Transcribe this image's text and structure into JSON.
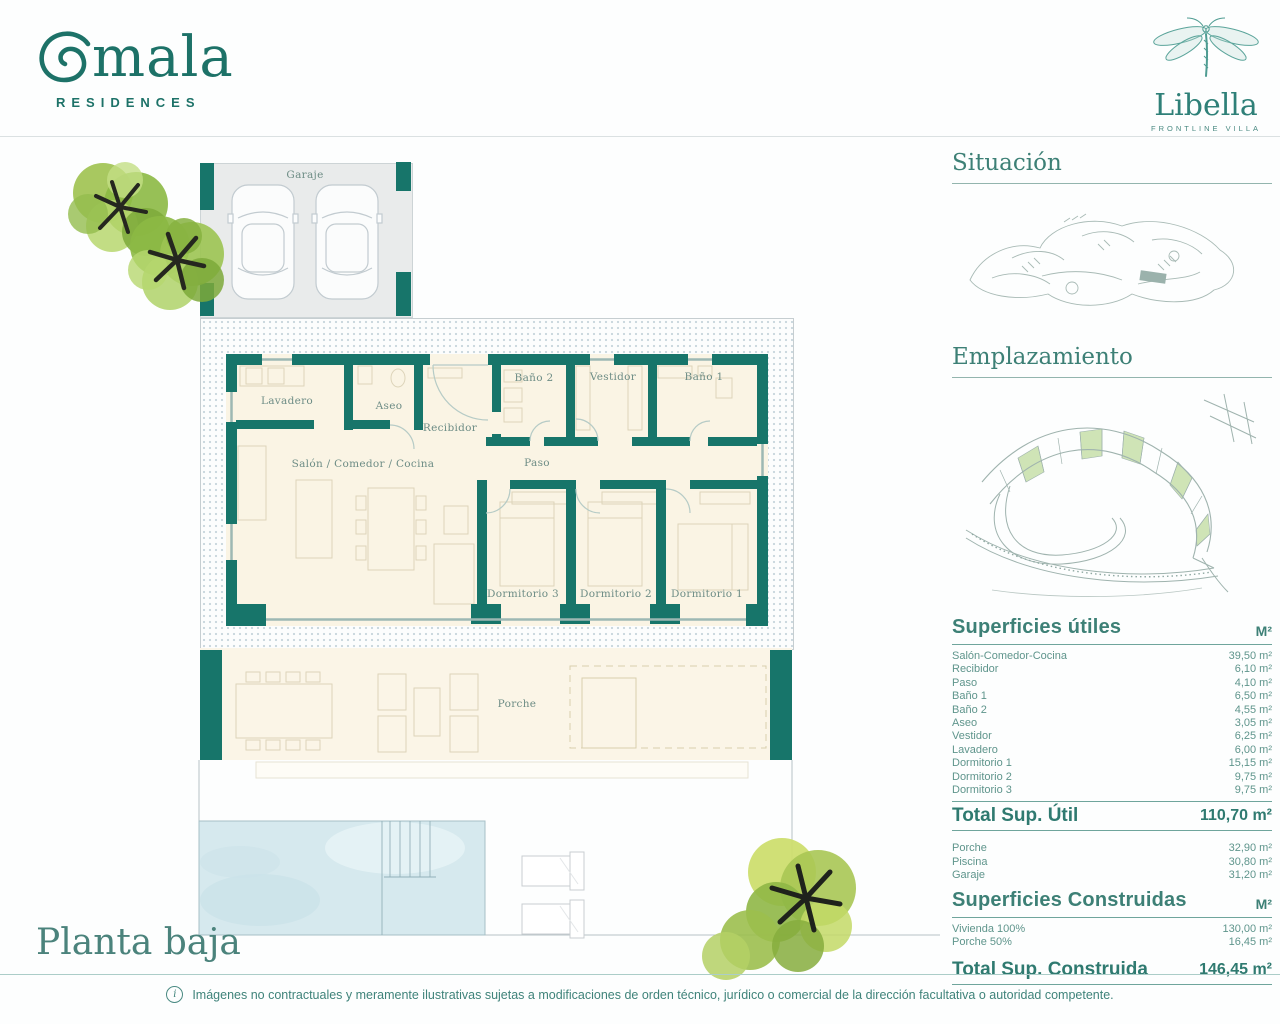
{
  "brand": {
    "name": "Omala",
    "name_rest": "mala",
    "residences": "RESIDENCES"
  },
  "villa": {
    "name": "Libella",
    "subtitle": "FRONTLINE VILLA"
  },
  "plan": {
    "title": "Planta baja",
    "rooms": {
      "garaje": "Garaje",
      "lavadero": "Lavadero",
      "aseo": "Aseo",
      "recibidor": "Recibidor",
      "bano_2": "Baño 2",
      "vestidor": "Vestidor",
      "bano_1": "Baño 1",
      "paso": "Paso",
      "salon": "Salón / Comedor / Cocina",
      "dormitorio_3": "Dormitorio 3",
      "dormitorio_2": "Dormitorio 2",
      "dormitorio_1": "Dormitorio 1",
      "porche": "Porche"
    }
  },
  "sections": {
    "situacion": "Situación",
    "emplazamiento": "Emplazamiento"
  },
  "superficies_utiles": {
    "title": "Superficies útiles",
    "unit": "M²",
    "rows": [
      {
        "label": "Salón-Comedor-Cocina",
        "value": "39,50 m²"
      },
      {
        "label": "Recibidor",
        "value": "6,10 m²"
      },
      {
        "label": "Paso",
        "value": "4,10 m²"
      },
      {
        "label": "Baño 1",
        "value": "6,50 m²"
      },
      {
        "label": "Baño 2",
        "value": "4,55 m²"
      },
      {
        "label": "Aseo",
        "value": "3,05 m²"
      },
      {
        "label": "Vestidor",
        "value": "6,25 m²"
      },
      {
        "label": "Lavadero",
        "value": "6,00 m²"
      },
      {
        "label": "Dormitorio 1",
        "value": "15,15 m²"
      },
      {
        "label": "Dormitorio 2",
        "value": "9,75 m²"
      },
      {
        "label": "Dormitorio 3",
        "value": "9,75 m²"
      }
    ],
    "total_label": "Total Sup. Útil",
    "total_value": "110,70 m²"
  },
  "superficies_anexas": {
    "rows": [
      {
        "label": "Porche",
        "value": "32,90 m²"
      },
      {
        "label": "Piscina",
        "value": "30,80 m²"
      },
      {
        "label": "Garaje",
        "value": "31,20 m²"
      }
    ]
  },
  "superficies_construidas": {
    "title": "Superficies Construidas",
    "unit": "M²",
    "rows": [
      {
        "label": "Vivienda 100%",
        "value": "130,00 m²"
      },
      {
        "label": "Porche 50%",
        "value": "16,45 m²"
      }
    ],
    "total_label": "Total Sup. Construida",
    "total_value": "146,45 m²"
  },
  "footer": {
    "info_icon": "i",
    "disclaimer": "Imágenes no contractuales y meramente ilustrativas sujetas a modificaciones de orden técnico, jurídico o comercial de la dirección facultativa o autoridad competente."
  },
  "colors": {
    "teal_wall": "#17756a",
    "heading_teal": "#3d8076",
    "table_text": "#5f958c",
    "pool_blue": "#d6e9ee",
    "parcel_green": "#cfe4b6"
  }
}
